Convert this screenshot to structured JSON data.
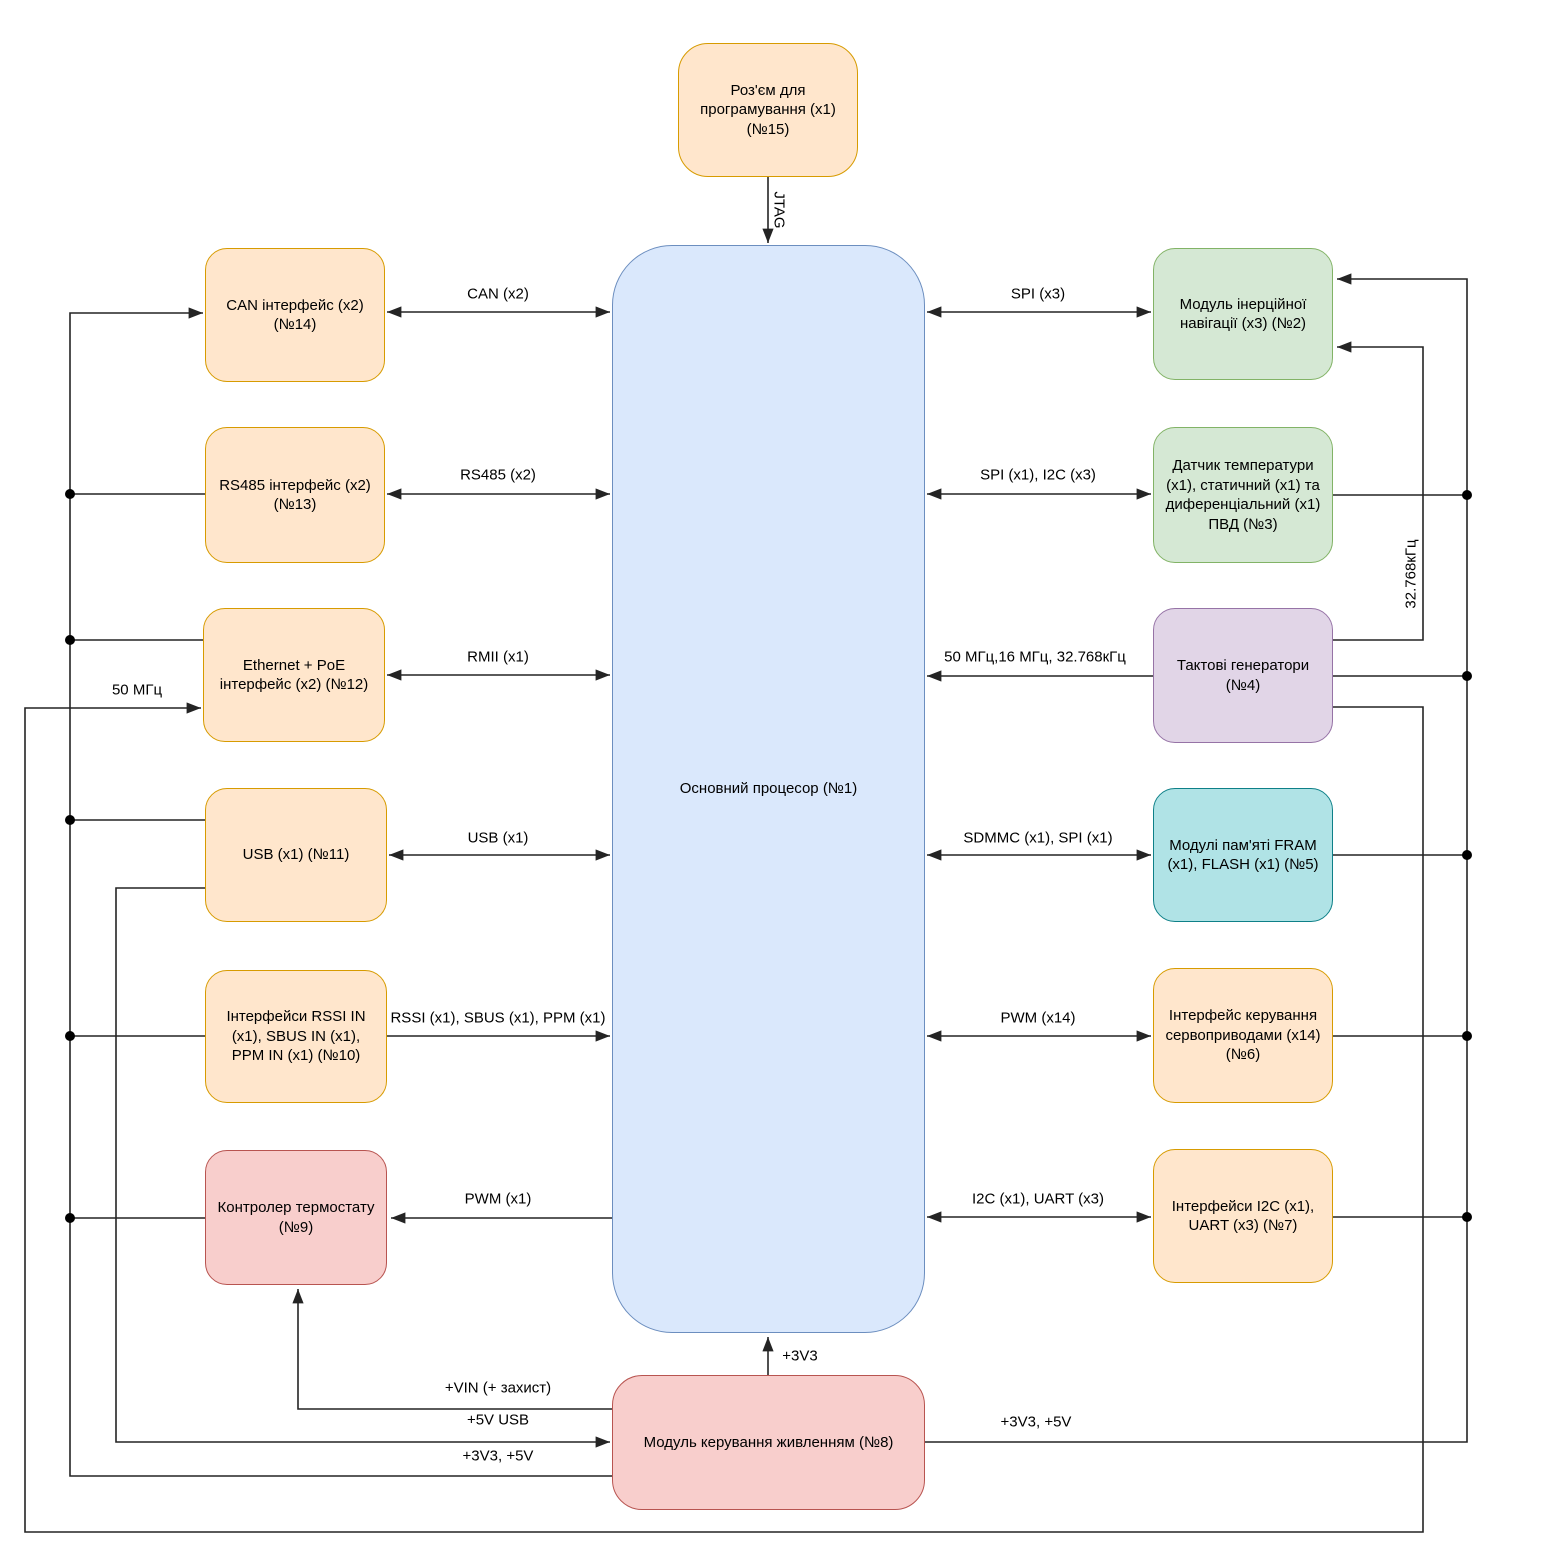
{
  "diagram_language": "Ukrainian",
  "colors": {
    "orange_fill": "#FFE6CC",
    "orange_stroke": "#D79B00",
    "blue_fill": "#DAE8FC",
    "blue_stroke": "#6C8EBF",
    "green_fill": "#D5E8D4",
    "green_stroke": "#82B366",
    "purple_fill": "#E1D5E7",
    "purple_stroke": "#9673A6",
    "red_fill": "#F8CECC",
    "red_stroke": "#B85450",
    "teal_fill": "#B0E3E6",
    "teal_stroke": "#0E8088",
    "wire": "#242424"
  },
  "blocks": [
    {
      "id": "programming",
      "label": "Роз'єм для програмування (x1) (№15)",
      "color": "orange"
    },
    {
      "id": "processor",
      "label": "Основний процесор (№1)",
      "color": "blue"
    },
    {
      "id": "can",
      "label": "CAN інтерфейс (x2) (№14)",
      "color": "orange"
    },
    {
      "id": "rs485",
      "label": "RS485 інтерфейс (x2) (№13)",
      "color": "orange"
    },
    {
      "id": "ethernet",
      "label": "Ethernet + PoE інтерфейс (x2) (№12)",
      "color": "orange"
    },
    {
      "id": "usb",
      "label": "USB (x1) (№11)",
      "color": "orange"
    },
    {
      "id": "rssi_in",
      "label": "Інтерфейси RSSI IN (x1), SBUS IN (x1), PPM IN (x1) (№10)",
      "color": "orange"
    },
    {
      "id": "thermostat",
      "label": "Контролер термостату (№9)",
      "color": "red"
    },
    {
      "id": "power",
      "label": "Модуль керування живленням (№8)",
      "color": "red"
    },
    {
      "id": "imu",
      "label": "Модуль інерційної навігації (x3) (№2)",
      "color": "green"
    },
    {
      "id": "sensors",
      "label": "Датчик температури (x1), статичний (x1) та диференціальний (x1) ПВД (№3)",
      "color": "green"
    },
    {
      "id": "clocks",
      "label": "Тактові генератори (№4)",
      "color": "purple"
    },
    {
      "id": "memory",
      "label": "Модулі пам'яті FRAM (x1), FLASH (x1) (№5)",
      "color": "teal"
    },
    {
      "id": "servo",
      "label": "Інтерфейс керування сервоприводами (x14) (№6)",
      "color": "orange"
    },
    {
      "id": "i2c_uart",
      "label": "Інтерфейси I2C (x1), UART (x3) (№7)",
      "color": "orange"
    }
  ],
  "edge_labels": {
    "jtag": "JTAG",
    "can": "CAN (x2)",
    "rs485": "RS485 (x2)",
    "rmii": "RMII (x1)",
    "usb": "USB (x1)",
    "rssi": "RSSI (x1), SBUS (x1), PPM (x1)",
    "pwm1": "PWM (x1)",
    "spi3": "SPI (x3)",
    "spi_i2c": "SPI (x1), I2C (x3)",
    "clocks": "50 МГц,16 МГц, 32.768кГц",
    "sdmmc": "SDMMC (x1), SPI (x1)",
    "pwm14": "PWM (x14)",
    "i2c_uart": "I2C (x1), UART (x3)",
    "p3v3": "+3V3",
    "vin": "+VIN (+ захист)",
    "v5usb": "+5V USB",
    "v33v5_left": "+3V3, +5V",
    "v33v5_right": "+3V3, +5V",
    "mhz50": "50 МГц",
    "khz32": "32.768кГц"
  }
}
